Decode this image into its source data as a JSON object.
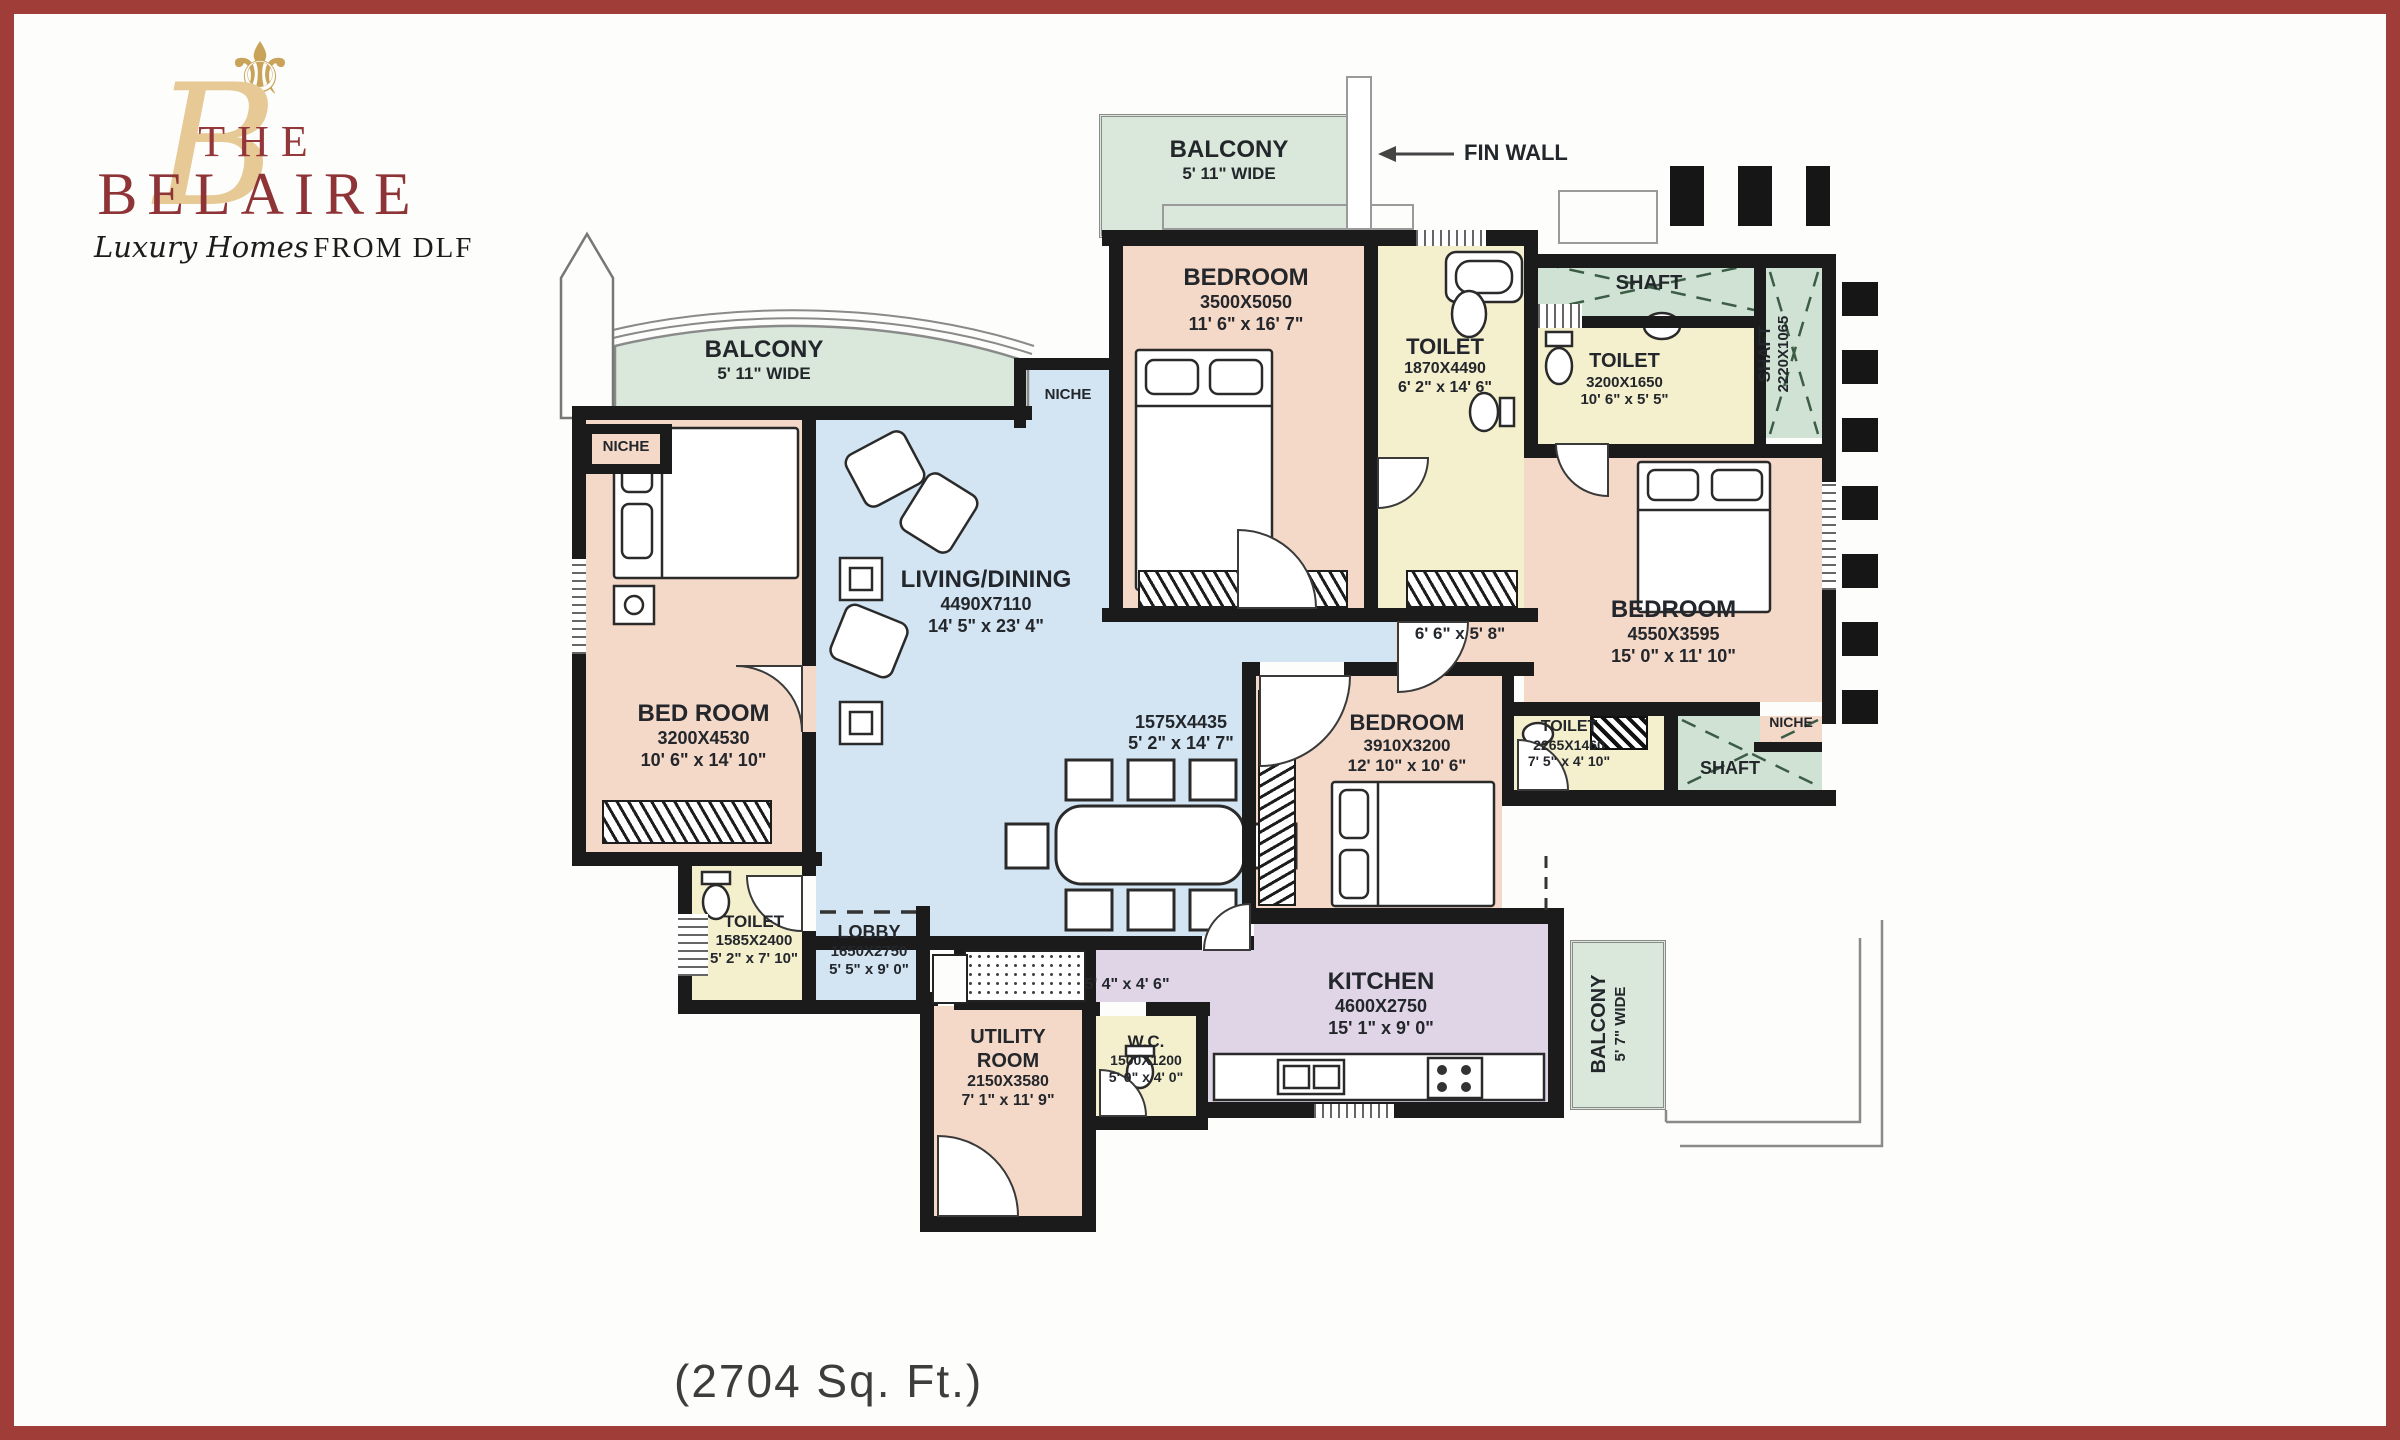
{
  "brand": {
    "the": "THE",
    "name": "BELAIRE",
    "tagline_script": "Luxury Homes",
    "tagline_serif": "FROM DLF",
    "fleur_icon": "fleur-de-lis",
    "monogram": "B"
  },
  "area_label": "(2704 Sq. Ft.)",
  "annotations": {
    "fin_wall": "FIN WALL",
    "niche_left": "NICHE",
    "niche_center": "NICHE",
    "niche_right": "NICHE"
  },
  "rooms": {
    "balcony_top": {
      "name": "BALCONY",
      "wide": "5' 11\" WIDE"
    },
    "bedroom_top": {
      "name": "BEDROOM",
      "mm": "3500X5050",
      "ft": "11' 6\" x 16' 7\""
    },
    "toilet_top": {
      "name": "TOILET",
      "mm": "1870X4490",
      "ft": "6' 2\" x 14' 6\""
    },
    "shaft_top": {
      "name": "SHAFT"
    },
    "toilet2": {
      "name": "TOILET",
      "mm": "3200X1650",
      "ft": "10' 6\" x 5' 5\""
    },
    "shaft_right": {
      "name": "SHAFT",
      "mm": "2220X1065"
    },
    "bedroom_right": {
      "name": "BEDROOM",
      "mm": "4550X3595",
      "ft": "15' 0\" x 11' 10\""
    },
    "balcony_left": {
      "name": "BALCONY",
      "wide": "5' 11\" WIDE"
    },
    "living": {
      "name": "LIVING/DINING",
      "mm": "4490X7110",
      "ft": "14' 5\" x 23' 4\""
    },
    "passage_1575": {
      "mm": "1575X4435",
      "ft": "5' 2\" x 14' 7\""
    },
    "bedroom_left": {
      "name": "BED ROOM",
      "mm": "3200X4530",
      "ft": "10' 6\" x 14' 10\""
    },
    "passage_66": {
      "ft": "6' 6\" x 5' 8\""
    },
    "bedroom_mid": {
      "name": "BEDROOM",
      "mm": "3910X3200",
      "ft": "12' 10\" x 10' 6\""
    },
    "toilet_mid": {
      "name": "TOILET",
      "mm": "2265X1460",
      "ft": "7' 5\" x 4' 10\""
    },
    "shaft_mid": {
      "name": "SHAFT"
    },
    "toilet_bl": {
      "name": "TOILET",
      "mm": "1585X2400",
      "ft": "5' 2\" x 7' 10\""
    },
    "lobby": {
      "name": "LOBBY",
      "mm": "1650X2750",
      "ft": "5' 5\" x 9' 0\""
    },
    "utility": {
      "name1": "UTILITY",
      "name2": "ROOM",
      "mm": "2150X3580",
      "ft": "7' 1\" x 11' 9\""
    },
    "wc": {
      "name": "W.C.",
      "mm": "1500X1200",
      "ft": "5' 0\" x 4' 0\""
    },
    "passage_54": {
      "ft": "5' 4\" x 4' 6\""
    },
    "kitchen": {
      "name": "KITCHEN",
      "mm": "4600X2750",
      "ft": "15' 1\" x 9' 0\""
    },
    "balcony_right": {
      "name": "BALCONY",
      "wide": "5' 7\" WIDE"
    }
  },
  "colors": {
    "frame": "#a03d38",
    "wall": "#1b1b1b",
    "bedroom_fill": "#f5d9c8",
    "living_fill": "#d3e5f2",
    "balcony_fill": "#d9e8da",
    "toilet_fill": "#f4efcd",
    "kitchen_fill": "#e0d5e7",
    "shaft_fill": "#cfe2d3",
    "logo_maroon": "#8e3336",
    "logo_gold": "#c9a35a"
  }
}
